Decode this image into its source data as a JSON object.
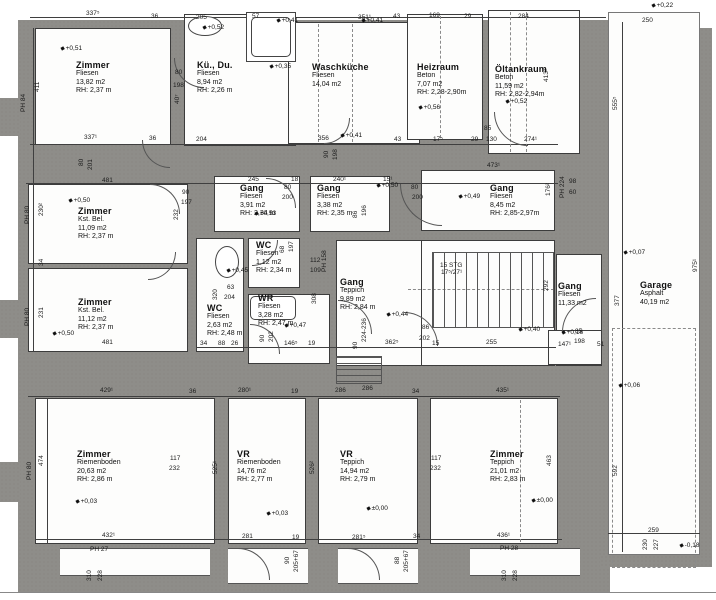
{
  "plan": {
    "colors": {
      "wall": "#8e8d89",
      "line": "#3f3f3f",
      "paper": "#ffffff"
    },
    "rooms": [
      {
        "id": "zimmer-nw",
        "name": "Zimmer",
        "lines": [
          "Fliesen",
          "13,82 m2",
          "RH: 2,37 m"
        ],
        "x": 76,
        "y": 60
      },
      {
        "id": "kue-du",
        "name": "Kü., Du.",
        "lines": [
          "Fliesen",
          "8,94 m2",
          "RH: 2,26 m"
        ],
        "x": 197,
        "y": 60
      },
      {
        "id": "waschkueche",
        "name": "Waschküche",
        "lines": [
          "Fliesen",
          "14,04 m2"
        ],
        "x": 312,
        "y": 62
      },
      {
        "id": "heizraum",
        "name": "Heizraum",
        "lines": [
          "Beton",
          "7,07 m2",
          "RH: 2,28-2,90m"
        ],
        "x": 417,
        "y": 62
      },
      {
        "id": "oeltankraum",
        "name": "Öltankraum",
        "lines": [
          "Beton",
          "11,59 m2",
          "RH: 2,82-2,94m"
        ],
        "x": 495,
        "y": 64
      },
      {
        "id": "gang-nw",
        "name": "Gang",
        "lines": [
          "Fliesen",
          "3,91 m2",
          "RH: 2,34 m"
        ],
        "x": 240,
        "y": 183
      },
      {
        "id": "gang-n",
        "name": "Gang",
        "lines": [
          "Fliesen",
          "3,38 m2",
          "RH: 2,35 m"
        ],
        "x": 317,
        "y": 183
      },
      {
        "id": "gang-ne",
        "name": "Gang",
        "lines": [
          "Fliesen",
          "8,45 m2",
          "RH: 2,85-2,97m"
        ],
        "x": 490,
        "y": 183
      },
      {
        "id": "zimmer-w1",
        "name": "Zimmer",
        "lines": [
          "Kst. Bel.",
          "11,09 m2",
          "RH: 2,37 m"
        ],
        "x": 78,
        "y": 206
      },
      {
        "id": "zimmer-w2",
        "name": "Zimmer",
        "lines": [
          "Kst. Bel.",
          "11,12 m2",
          "RH: 2,37 m"
        ],
        "x": 78,
        "y": 297
      },
      {
        "id": "wc-klein",
        "name": "WC",
        "lines": [
          "Fliesen",
          "1,12 m2",
          "RH: 2,34 m"
        ],
        "x": 256,
        "y": 240
      },
      {
        "id": "wc-links",
        "name": "WC",
        "lines": [
          "Fliesen",
          "2,63 m2",
          "RH: 2,48 m"
        ],
        "x": 207,
        "y": 303
      },
      {
        "id": "wr",
        "name": "WR",
        "lines": [
          "Fliesen",
          "3,28 m2",
          "RH: 2,47 m"
        ],
        "x": 258,
        "y": 293
      },
      {
        "id": "gang-mitte",
        "name": "Gang",
        "lines": [
          "Teppich",
          "9,89 m2",
          "RH: 2,84 m"
        ],
        "x": 340,
        "y": 277
      },
      {
        "id": "gang-ost",
        "name": "Gang",
        "lines": [
          "Fliesen",
          "11,33 m2"
        ],
        "x": 558,
        "y": 281
      },
      {
        "id": "garage",
        "name": "Garage",
        "lines": [
          "Asphalt",
          "40,19 m2"
        ],
        "x": 640,
        "y": 280
      },
      {
        "id": "zimmer-sw",
        "name": "Zimmer",
        "lines": [
          "Riemenboden",
          "20,63 m2",
          "RH: 2,86 m"
        ],
        "x": 77,
        "y": 449
      },
      {
        "id": "vr-1",
        "name": "VR",
        "lines": [
          "Riemenboden",
          "14,76 m2",
          "RH: 2,77 m"
        ],
        "x": 237,
        "y": 449
      },
      {
        "id": "vr-2",
        "name": "VR",
        "lines": [
          "Teppich",
          "14,94 m2",
          "RH: 2,79 m"
        ],
        "x": 340,
        "y": 449
      },
      {
        "id": "zimmer-se",
        "name": "Zimmer",
        "lines": [
          "Teppich",
          "21,01 m2",
          "RH: 2,83 m"
        ],
        "x": 490,
        "y": 449
      }
    ],
    "markers": [
      {
        "t": "+0,51",
        "x": 60,
        "y": 45
      },
      {
        "t": "+0,52",
        "x": 202,
        "y": 24
      },
      {
        "t": "+0,35",
        "x": 269,
        "y": 63
      },
      {
        "t": "+0,41",
        "x": 276,
        "y": 17
      },
      {
        "t": "+0,41",
        "x": 361,
        "y": 17
      },
      {
        "t": "+0,41",
        "x": 340,
        "y": 132
      },
      {
        "t": "+0,56",
        "x": 418,
        "y": 104
      },
      {
        "t": "+0,52",
        "x": 505,
        "y": 98
      },
      {
        "t": "+0,22",
        "x": 651,
        "y": 2
      },
      {
        "t": "+0,50",
        "x": 68,
        "y": 197
      },
      {
        "t": "+0,53",
        "x": 254,
        "y": 210
      },
      {
        "t": "+0,50",
        "x": 376,
        "y": 182
      },
      {
        "t": "+0,49",
        "x": 458,
        "y": 193
      },
      {
        "t": "+0,45",
        "x": 226,
        "y": 267
      },
      {
        "t": "+0,47",
        "x": 284,
        "y": 322
      },
      {
        "t": "+0,44",
        "x": 386,
        "y": 311
      },
      {
        "t": "+0,40",
        "x": 518,
        "y": 326
      },
      {
        "t": "+0,16",
        "x": 561,
        "y": 329
      },
      {
        "t": "+0,50",
        "x": 52,
        "y": 330
      },
      {
        "t": "+0,03",
        "x": 75,
        "y": 498
      },
      {
        "t": "+0,03",
        "x": 266,
        "y": 510
      },
      {
        "t": "±0,00",
        "x": 366,
        "y": 505
      },
      {
        "t": "±0,00",
        "x": 531,
        "y": 497
      },
      {
        "t": "+0,07",
        "x": 623,
        "y": 249
      },
      {
        "t": "+0,06",
        "x": 618,
        "y": 382
      },
      {
        "t": "-0,18",
        "x": 679,
        "y": 542
      }
    ],
    "dims": [
      {
        "t": "337⁵",
        "x": 86,
        "y": 10
      },
      {
        "t": "36",
        "x": 151,
        "y": 13
      },
      {
        "t": "205",
        "x": 196,
        "y": 14
      },
      {
        "t": "57",
        "x": 252,
        "y": 13
      },
      {
        "t": "351¹",
        "x": 358,
        "y": 14
      },
      {
        "t": "43",
        "x": 393,
        "y": 13
      },
      {
        "t": "169",
        "x": 429,
        "y": 12
      },
      {
        "t": "29",
        "x": 464,
        "y": 13
      },
      {
        "t": "284",
        "x": 518,
        "y": 13
      },
      {
        "t": "250",
        "x": 642,
        "y": 17
      },
      {
        "t": "337¹",
        "x": 84,
        "y": 134
      },
      {
        "t": "36",
        "x": 149,
        "y": 135
      },
      {
        "t": "204",
        "x": 196,
        "y": 136
      },
      {
        "t": "356",
        "x": 318,
        "y": 135
      },
      {
        "t": "43",
        "x": 394,
        "y": 136
      },
      {
        "t": "17⁵",
        "x": 433,
        "y": 136
      },
      {
        "t": "29",
        "x": 471,
        "y": 136
      },
      {
        "t": "130",
        "x": 486,
        "y": 136
      },
      {
        "t": "85",
        "x": 484,
        "y": 125
      },
      {
        "t": "274¹",
        "x": 524,
        "y": 136
      },
      {
        "t": "90",
        "x": 323,
        "y": 158,
        "r": 1
      },
      {
        "t": "198",
        "x": 332,
        "y": 160,
        "r": 1
      },
      {
        "t": "411",
        "x": 34,
        "y": 92,
        "r": 1
      },
      {
        "t": "PH 84",
        "x": 20,
        "y": 112,
        "r": 1
      },
      {
        "t": "230²",
        "x": 38,
        "y": 216,
        "r": 1
      },
      {
        "t": "PH 80",
        "x": 24,
        "y": 224,
        "r": 1
      },
      {
        "t": "34",
        "x": 38,
        "y": 266,
        "r": 1
      },
      {
        "t": "231",
        "x": 38,
        "y": 318,
        "r": 1
      },
      {
        "t": "PH 80",
        "x": 24,
        "y": 326,
        "r": 1
      },
      {
        "t": "474",
        "x": 38,
        "y": 466,
        "r": 1
      },
      {
        "t": "PH 80",
        "x": 26,
        "y": 480,
        "r": 1
      },
      {
        "t": "80",
        "x": 78,
        "y": 166,
        "r": 1
      },
      {
        "t": "201",
        "x": 87,
        "y": 170,
        "r": 1
      },
      {
        "t": "481",
        "x": 102,
        "y": 177
      },
      {
        "t": "90",
        "x": 182,
        "y": 189
      },
      {
        "t": "197",
        "x": 181,
        "y": 199
      },
      {
        "t": "232",
        "x": 173,
        "y": 220,
        "r": 1
      },
      {
        "t": "245",
        "x": 248,
        "y": 176
      },
      {
        "t": "18",
        "x": 291,
        "y": 176
      },
      {
        "t": "80",
        "x": 284,
        "y": 184
      },
      {
        "t": "200",
        "x": 282,
        "y": 194
      },
      {
        "t": "240¹",
        "x": 333,
        "y": 176
      },
      {
        "t": "15¹",
        "x": 383,
        "y": 176
      },
      {
        "t": "86",
        "x": 352,
        "y": 218,
        "r": 1
      },
      {
        "t": "196",
        "x": 361,
        "y": 216,
        "r": 1
      },
      {
        "t": "473¹",
        "x": 487,
        "y": 162
      },
      {
        "t": "80",
        "x": 411,
        "y": 184
      },
      {
        "t": "200",
        "x": 412,
        "y": 194
      },
      {
        "t": "176²",
        "x": 545,
        "y": 196,
        "r": 1
      },
      {
        "t": "PH 224",
        "x": 559,
        "y": 198,
        "r": 1
      },
      {
        "t": "98",
        "x": 569,
        "y": 178
      },
      {
        "t": "60",
        "x": 569,
        "y": 189
      },
      {
        "t": "481",
        "x": 102,
        "y": 339
      },
      {
        "t": "34",
        "x": 200,
        "y": 340
      },
      {
        "t": "63",
        "x": 227,
        "y": 284
      },
      {
        "t": "204",
        "x": 224,
        "y": 294
      },
      {
        "t": "320",
        "x": 212,
        "y": 300,
        "r": 1
      },
      {
        "t": "68",
        "x": 279,
        "y": 253,
        "r": 1
      },
      {
        "t": "197",
        "x": 288,
        "y": 252,
        "r": 1
      },
      {
        "t": "112",
        "x": 310,
        "y": 257
      },
      {
        "t": "109",
        "x": 310,
        "y": 267
      },
      {
        "t": "PH 158",
        "x": 321,
        "y": 272,
        "r": 1
      },
      {
        "t": "308",
        "x": 311,
        "y": 304,
        "r": 1
      },
      {
        "t": "90",
        "x": 259,
        "y": 342,
        "r": 1
      },
      {
        "t": "202",
        "x": 268,
        "y": 342,
        "r": 1
      },
      {
        "t": "88",
        "x": 218,
        "y": 340
      },
      {
        "t": "26",
        "x": 231,
        "y": 340
      },
      {
        "t": "146⁵",
        "x": 284,
        "y": 340
      },
      {
        "t": "19",
        "x": 308,
        "y": 340
      },
      {
        "t": "90",
        "x": 352,
        "y": 349,
        "r": 1
      },
      {
        "t": "224-236",
        "x": 361,
        "y": 342,
        "r": 1
      },
      {
        "t": "362⁵",
        "x": 385,
        "y": 339
      },
      {
        "t": "286",
        "x": 362,
        "y": 385
      },
      {
        "t": "86",
        "x": 422,
        "y": 324
      },
      {
        "t": "202",
        "x": 419,
        "y": 335
      },
      {
        "t": "15",
        "x": 432,
        "y": 340
      },
      {
        "t": "255",
        "x": 486,
        "y": 339
      },
      {
        "t": "15 STG",
        "x": 440,
        "y": 262
      },
      {
        "t": "17⁵/27¹",
        "x": 441,
        "y": 269
      },
      {
        "t": "292",
        "x": 543,
        "y": 291,
        "r": 1
      },
      {
        "t": "147¹",
        "x": 558,
        "y": 341
      },
      {
        "t": "85",
        "x": 575,
        "y": 328
      },
      {
        "t": "198",
        "x": 574,
        "y": 338
      },
      {
        "t": "51",
        "x": 597,
        "y": 341
      },
      {
        "t": "40⁷",
        "x": 174,
        "y": 104,
        "r": 1
      },
      {
        "t": "80",
        "x": 175,
        "y": 69
      },
      {
        "t": "198",
        "x": 173,
        "y": 82
      },
      {
        "t": "413²",
        "x": 543,
        "y": 82,
        "r": 1
      },
      {
        "t": "555⁵",
        "x": 612,
        "y": 110,
        "r": 1
      },
      {
        "t": "975¹",
        "x": 692,
        "y": 272,
        "r": 1
      },
      {
        "t": "377",
        "x": 614,
        "y": 306,
        "r": 1
      },
      {
        "t": "592",
        "x": 612,
        "y": 476,
        "r": 1
      },
      {
        "t": "259",
        "x": 648,
        "y": 527
      },
      {
        "t": "230",
        "x": 642,
        "y": 550,
        "r": 1
      },
      {
        "t": "227",
        "x": 653,
        "y": 550,
        "r": 1
      },
      {
        "t": "429¹",
        "x": 100,
        "y": 387
      },
      {
        "t": "36",
        "x": 189,
        "y": 388
      },
      {
        "t": "280¹",
        "x": 238,
        "y": 387
      },
      {
        "t": "19",
        "x": 291,
        "y": 388
      },
      {
        "t": "286",
        "x": 335,
        "y": 387
      },
      {
        "t": "34",
        "x": 412,
        "y": 388
      },
      {
        "t": "435¹",
        "x": 496,
        "y": 387
      },
      {
        "t": "117",
        "x": 170,
        "y": 455
      },
      {
        "t": "232",
        "x": 169,
        "y": 465
      },
      {
        "t": "525¹",
        "x": 212,
        "y": 474,
        "r": 1
      },
      {
        "t": "526²",
        "x": 309,
        "y": 474,
        "r": 1
      },
      {
        "t": "117",
        "x": 431,
        "y": 455
      },
      {
        "t": "232",
        "x": 430,
        "y": 465
      },
      {
        "t": "463",
        "x": 546,
        "y": 466,
        "r": 1
      },
      {
        "t": "432¹",
        "x": 102,
        "y": 532
      },
      {
        "t": "PH 27",
        "x": 90,
        "y": 546
      },
      {
        "t": "310",
        "x": 86,
        "y": 581,
        "r": 1
      },
      {
        "t": "228",
        "x": 97,
        "y": 581,
        "r": 1
      },
      {
        "t": "281",
        "x": 242,
        "y": 533
      },
      {
        "t": "19",
        "x": 292,
        "y": 534
      },
      {
        "t": "281⁵",
        "x": 352,
        "y": 534
      },
      {
        "t": "34",
        "x": 413,
        "y": 533
      },
      {
        "t": "90",
        "x": 284,
        "y": 564,
        "r": 1
      },
      {
        "t": "205+67",
        "x": 293,
        "y": 572,
        "r": 1
      },
      {
        "t": "88",
        "x": 394,
        "y": 564,
        "r": 1
      },
      {
        "t": "205+67",
        "x": 403,
        "y": 572,
        "r": 1
      },
      {
        "t": "436¹",
        "x": 497,
        "y": 532
      },
      {
        "t": "PH 28",
        "x": 500,
        "y": 545
      },
      {
        "t": "310",
        "x": 501,
        "y": 581,
        "r": 1
      },
      {
        "t": "228",
        "x": 512,
        "y": 581,
        "r": 1
      }
    ]
  }
}
